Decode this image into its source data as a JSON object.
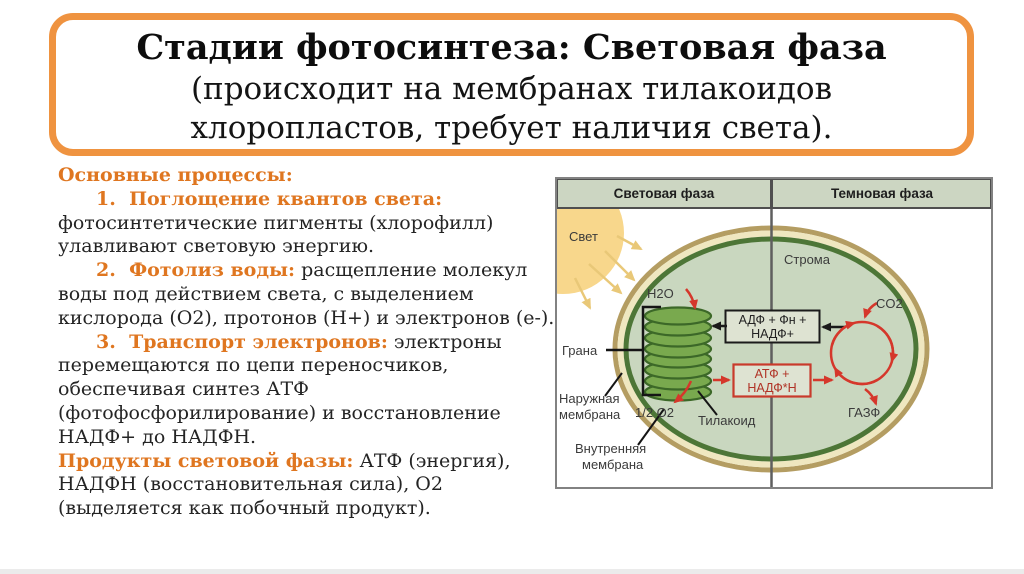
{
  "title": {
    "line1": "Стадии фотосинтеза: Световая фаза",
    "line2": "(происходит на мембранах тилакоидов",
    "line3": "хлоропластов, требует наличия света)."
  },
  "body": {
    "lines": [
      {
        "bold": "Основные процессы:",
        "rest": ""
      },
      {
        "bold": "1.  Поглощение квантов света:",
        "rest": ""
      },
      {
        "bold": "",
        "rest": "фотосинтетические пигменты (хлорофилл)"
      },
      {
        "bold": "",
        "rest": "улавливают световую энергию."
      },
      {
        "bold": "2.  Фотолиз воды:",
        "rest": " расщепление молекул"
      },
      {
        "bold": "",
        "rest": "воды под действием света, с выделением"
      },
      {
        "bold": "",
        "rest": "кислорода (О2), протонов (Н+) и электронов (е-)."
      },
      {
        "bold": "3.  Транспорт электронов:",
        "rest": " электроны"
      },
      {
        "bold": "",
        "rest": "перемещаются по цепи переносчиков,"
      },
      {
        "bold": "",
        "rest": "обеспечивая синтез АТФ"
      },
      {
        "bold": "",
        "rest": "(фотофосфорилирование) и восстановление"
      },
      {
        "bold": "",
        "rest": "НАДФ+ до НАДФН."
      },
      {
        "bold": "Продукты световой фазы:",
        "rest": " АТФ (энергия),"
      },
      {
        "bold": "",
        "rest": "НАДФН (восстановительная сила), О2"
      },
      {
        "bold": "",
        "rest": "(выделяется как побочный продукт)."
      }
    ]
  },
  "diagram": {
    "header": {
      "left": "Световая фаза",
      "right": "Темновая фаза"
    },
    "labels": {
      "svet": "Свет",
      "stroma": "Строма",
      "h2o": "H2O",
      "grana": "Грана",
      "naruzhnaya1": "Наружная",
      "naruzhnaya2": "мембрана",
      "o2": "1/2 O2",
      "tilakoid": "Тилакоид",
      "vnutrennyaya1": "Внутренняя",
      "vnutrennyaya2": "мембрана",
      "co2": "CO2",
      "gazf": "ГАЗФ",
      "adf1": "АДФ + Фн +",
      "adf2": "НАДФ+",
      "atf1": "АТФ +",
      "atf2": "НАДФ*Н"
    }
  },
  "colors": {
    "accent_orange": "#ef9340",
    "heading_orange": "#df7620",
    "arrow_red": "#d5372b",
    "chloroplast_fill": "#c9d7bf",
    "chloroplast_dark_ring": "#4d7637",
    "chloroplast_cream_ring": "#efe7c0",
    "chloroplast_tan_ring": "#b49d62",
    "header_fill": "#ccd6c2",
    "sun_fill": "#f8d78c",
    "box_fill": "#dee3d2",
    "grana_fill": "#79a94e"
  }
}
